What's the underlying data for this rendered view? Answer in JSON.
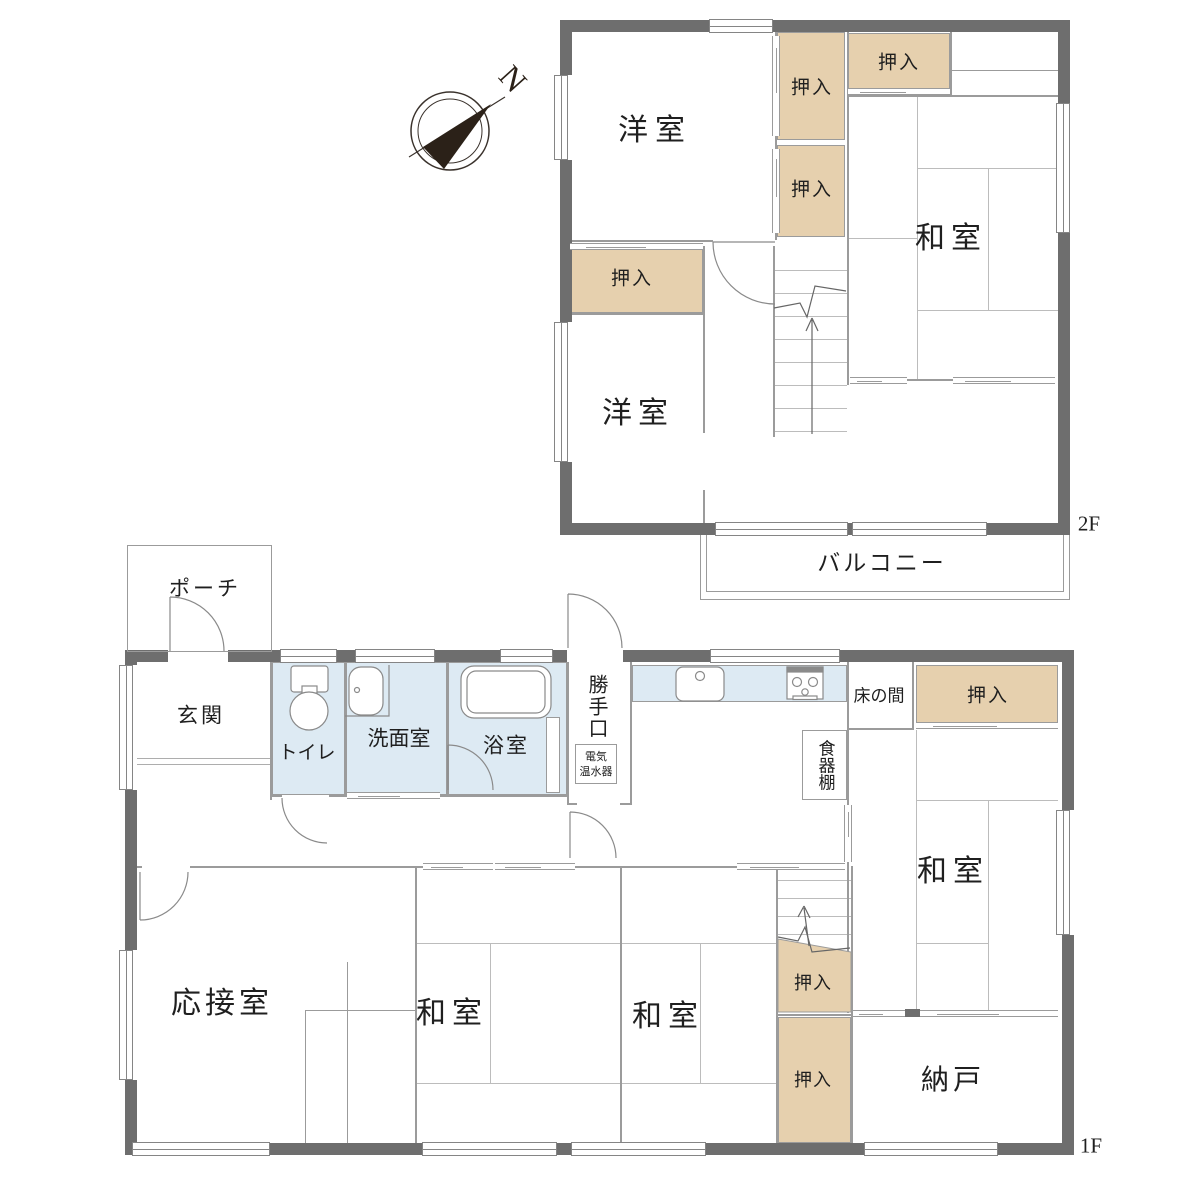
{
  "compass": {
    "label": "N"
  },
  "colors": {
    "wall": "#6e6e6e",
    "closet_fill": "#e6d0ae",
    "wet_fill": "#ddeaf3",
    "line": "#9b9b9b"
  },
  "floor2": {
    "floor_label": "2F",
    "rooms": {
      "western_room_north": "洋室",
      "western_room_south": "洋室",
      "japanese_room": "和室",
      "closet_hall_upper": "押入",
      "closet_hall_lower": "押入",
      "closet_northeast": "押入",
      "closet_west": "押入",
      "balcony": "バルコニー"
    }
  },
  "floor1": {
    "floor_label": "1F",
    "rooms": {
      "porch": "ポーチ",
      "entrance": "玄関",
      "toilet": "トイレ",
      "washroom": "洗面室",
      "bathroom": "浴室",
      "back_door": "勝手口",
      "water_heater_line1": "電気",
      "water_heater_line2": "温水器",
      "tokonoma": "床の間",
      "closet_northeast": "押入",
      "cupboard": "食器棚",
      "japanese_room_east": "和室",
      "reception_room": "応接室",
      "japanese_room_center_west": "和室",
      "japanese_room_center_east": "和室",
      "closet_by_stairs": "押入",
      "closet_south": "押入",
      "storage_room": "納戸"
    }
  }
}
